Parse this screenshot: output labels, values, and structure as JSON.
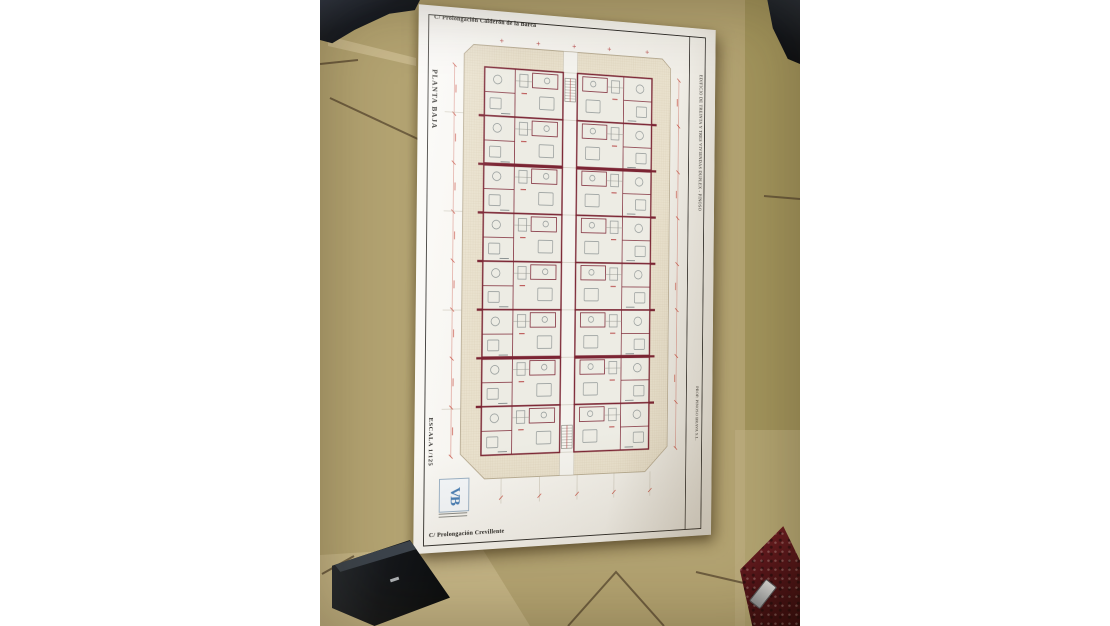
{
  "sheet": {
    "street_top": "C/ Prolongación Calderón de la Barca",
    "street_bottom": "C/ Prolongación Crevillente",
    "floor_label": "PLANTA BAJA",
    "scale_label": "ESCALA 1/125",
    "side_title": "EDIFICIO DE TREINTA Y TRES VIVIENDAS DUPLEX - PINOSO",
    "side_promoter": "PROP. PINOSO BRAVA S.L.",
    "logo_monogram": "VB",
    "colors": {
      "wall_maroon": "#7b2433",
      "dimension_red": "#c0392b",
      "hatch_beige": "#e9e1cd",
      "paper": "#f4f2ec",
      "logo_blue": "#4a7fb5"
    }
  },
  "photo": {
    "colors": {
      "tile_tan": "#b3a371",
      "grout_brown": "#5d4c33",
      "dark_objects": "#14171c",
      "red_tool": "#6e1b20"
    }
  }
}
